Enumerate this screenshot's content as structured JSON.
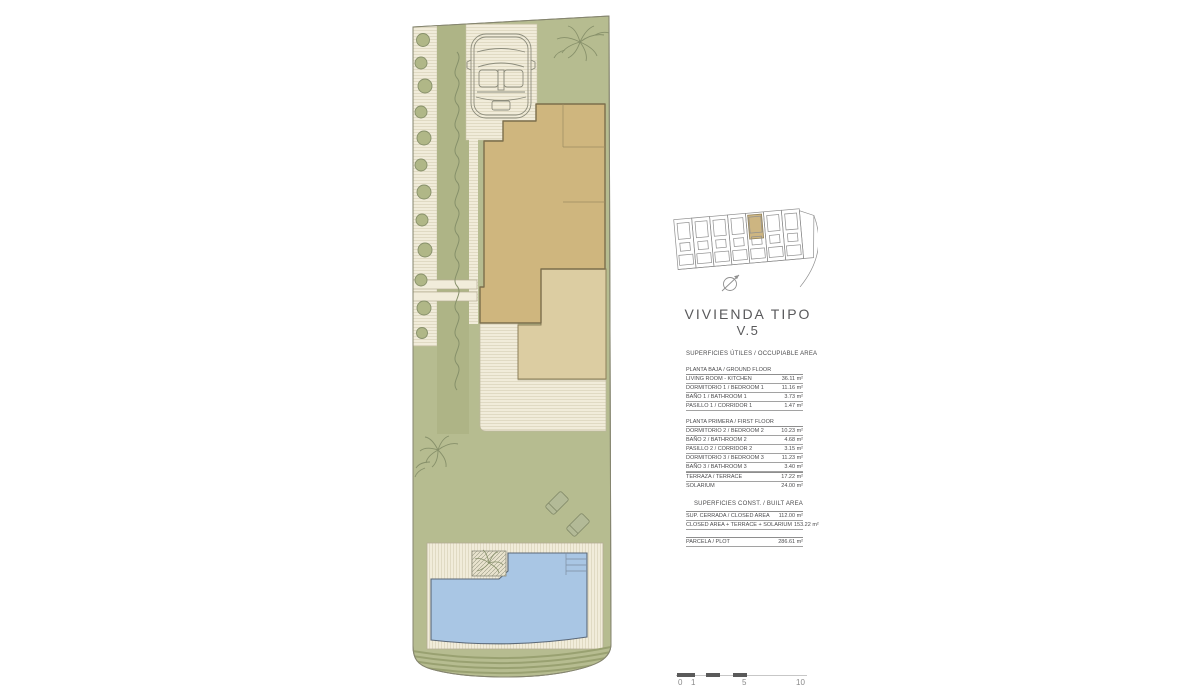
{
  "title": {
    "line1": "VIVIENDA TIPO",
    "line2": "V.5"
  },
  "surfaces": {
    "useful_header": "SUPERFICIES ÚTILES / OCCUPIABLE AREA",
    "ground_floor": {
      "title": "PLANTA BAJA / GROUND FLOOR",
      "rows": [
        {
          "label": "LIVING ROOM - KITCHEN",
          "value": "36.11 m²"
        },
        {
          "label": "DORMITORIO 1 / BEDROOM 1",
          "value": "11.16 m²"
        },
        {
          "label": "BAÑO 1 / BATHROOM 1",
          "value": "3.73 m²"
        },
        {
          "label": "PASILLO 1 / CORRIDOR 1",
          "value": "1.47 m²"
        }
      ]
    },
    "first_floor": {
      "title": "PLANTA PRIMERA / FIRST FLOOR",
      "rows": [
        {
          "label": "DORMITORIO 2 / BEDROOM 2",
          "value": "10.23 m²"
        },
        {
          "label": "BAÑO 2 / BATHROOM 2",
          "value": "4.68 m²"
        },
        {
          "label": "PASILLO 2 / CORRIDOR 2",
          "value": "3.15 m²"
        },
        {
          "label": "DORMITORIO 3 / BEDROOM 3",
          "value": "11.23 m²"
        },
        {
          "label": "BAÑO 3 / BATHROOM 3",
          "value": "3.40 m²"
        }
      ]
    },
    "outdoor_rows": [
      {
        "label": "TERRAZA / TERRACE",
        "value": "17.22 m²"
      },
      {
        "label": "SOLARIUM",
        "value": "24.00 m²"
      }
    ],
    "built_header": "SUPERFICIES CONST. / BUILT AREA",
    "built_rows": [
      {
        "label": "SUP. CERRADA / CLOSED AREA",
        "value": "112.00 m²"
      },
      {
        "label": "CLOSED AREA + TERRACE + SOLARIUM",
        "value": "153.22 m²"
      }
    ],
    "plot_row": {
      "label": "PARCELA / PLOT",
      "value": "286.61 m²"
    }
  },
  "scale_bar": {
    "labels": [
      "0",
      "1",
      "5",
      "10"
    ]
  },
  "colors": {
    "garden_green": "#b6bc90",
    "strip_green": "#aeb486",
    "paving_cream": "#f1ecda",
    "house_tan": "#cfb67e",
    "terrace_tan": "#dccda2",
    "pool_blue": "#a9c6e4",
    "keyplan_highlight_tan": "#cdb581",
    "text_gray": "#59595b"
  }
}
